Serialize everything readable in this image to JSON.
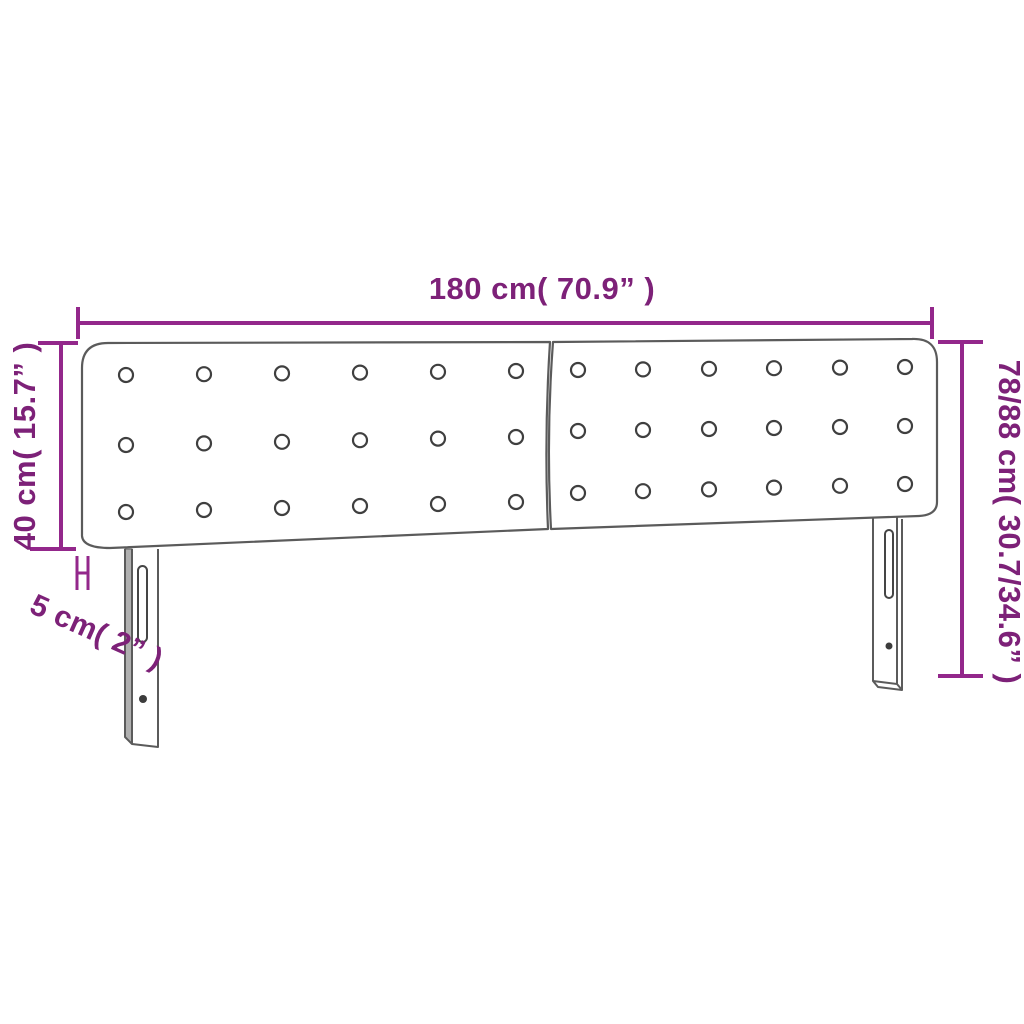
{
  "diagram_type": "furniture-dimension-diagram",
  "product": "upholstered headboard with two button-tufted panels and two slotted mounting legs",
  "labels": {
    "width": "180 cm( 70.9” )",
    "height_panel": "40 cm( 15.7” )",
    "height_total": "78/88 cm( 30.7/34.6” )",
    "depth": "5 cm( 2” )"
  },
  "structure": {
    "panels": 2,
    "button_rows": 3,
    "button_columns": 6,
    "legs": 2
  },
  "colors": {
    "dimension_line": "#93278B",
    "dimension_text": "#7D2178",
    "product_outline": "#5B5B5B",
    "leg_shadow": "#B0B0B0",
    "background": "#FFFFFF"
  }
}
